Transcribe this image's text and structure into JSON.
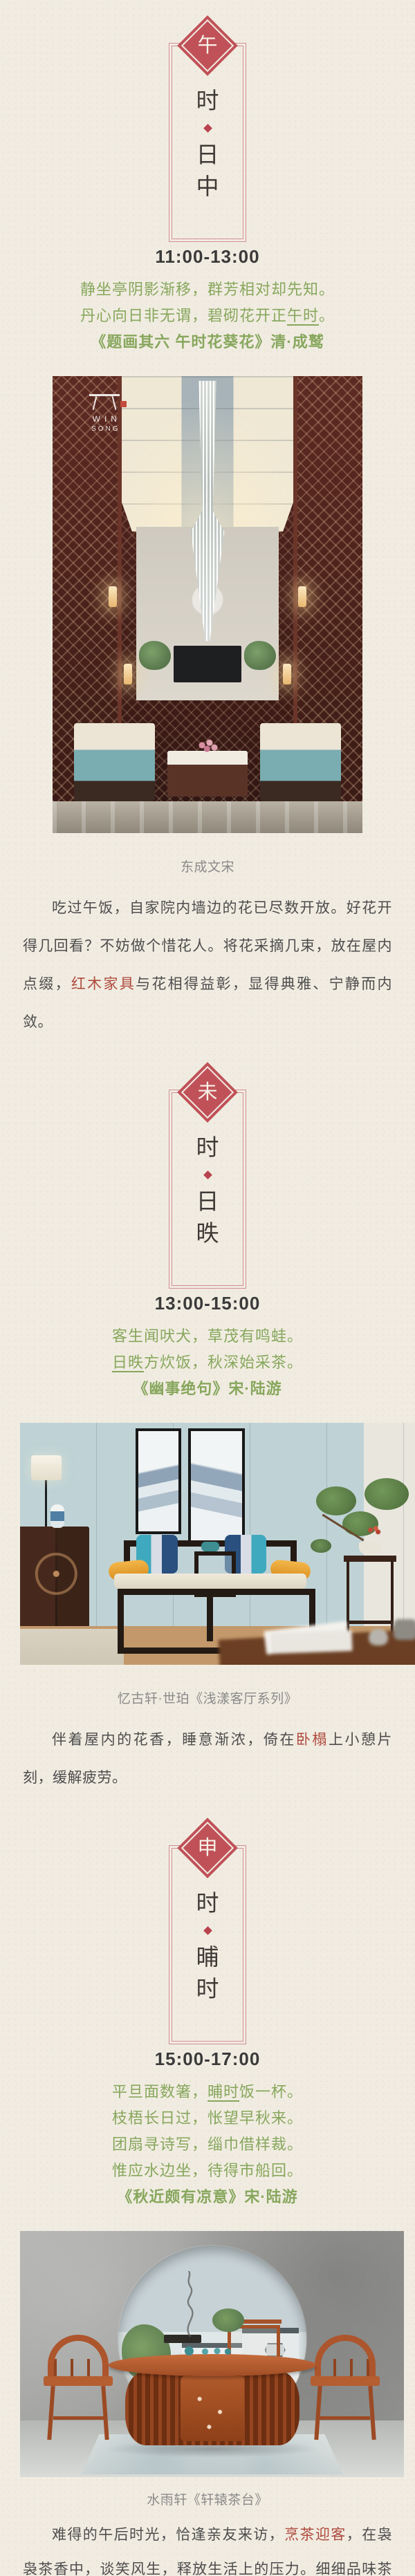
{
  "colors": {
    "background": "#f1ece1",
    "accent_red": "#c05158",
    "frame_rose": "#d28e96",
    "bullet_red": "#b8434e",
    "poem_green": "#87a75d",
    "link_red": "#ae4a3e",
    "body_text": "#4d4d4d",
    "caption_gray": "#8a8a8a",
    "time_text": "#3a3a3a"
  },
  "sections": [
    {
      "branch": "午",
      "frame_chars": [
        "时",
        "日",
        "中"
      ],
      "time_label": "11:00-13:00",
      "poem": {
        "lines": [
          {
            "pre": "静坐亭阴影渐移，群芳相对却先知。",
            "u": "",
            "post": ""
          },
          {
            "pre": "丹心向日非无谓，碧砌花开正",
            "u": "午时",
            "post": "。"
          }
        ],
        "source": "《题画其六 午时花葵花》清·成鹫"
      },
      "photo": {
        "watermark_top": "WIN",
        "watermark_bottom": "SONG"
      },
      "caption": "东成文宋",
      "paragraph": {
        "pre": "吃过午饭，自家院内墙边的花已尽数开放。好花开得几回看？不妨做个惜花人。将花采摘几束，放在屋内点缀，",
        "hl": "红木家具",
        "post": "与花相得益彰，显得典雅、宁静而内敛。"
      }
    },
    {
      "branch": "未",
      "frame_chars": [
        "时",
        "日",
        "昳"
      ],
      "time_label": "13:00-15:00",
      "poem": {
        "lines": [
          {
            "pre": "客生闻吠犬，草茂有鸣蛙。",
            "u": "",
            "post": ""
          },
          {
            "pre": "",
            "u": "日昳",
            "post": "方炊饭，秋深始采茶。"
          }
        ],
        "source": "《幽事绝句》宋·陆游"
      },
      "caption": "忆古轩·世珀《浅漾客厅系列》",
      "paragraph": {
        "pre": "伴着屋内的花香，睡意渐浓，倚在",
        "hl": "卧榻",
        "post": "上小憩片刻，缓解疲劳。"
      }
    },
    {
      "branch": "申",
      "frame_chars": [
        "时",
        "晡",
        "时"
      ],
      "time_label": "15:00-17:00",
      "poem": {
        "lines": [
          {
            "pre": "平旦面数箸，",
            "u": "晡时",
            "post": "饭一杯。"
          },
          {
            "pre": "枝梧长日过，怅望早秋来。",
            "u": "",
            "post": ""
          },
          {
            "pre": "团扇寻诗写，缁巾借样裁。",
            "u": "",
            "post": ""
          },
          {
            "pre": "惟应水边坐，待得市船回。",
            "u": "",
            "post": ""
          }
        ],
        "source": "《秋近颇有凉意》宋·陆游"
      },
      "caption": "水雨轩《轩辕茶台》",
      "paragraph": {
        "pre": "难得的午后时光，恰逢亲友来访，",
        "hl": "烹茶迎客",
        "post": "，在袅袅茶香中，谈笑风生，释放生活上的压力。细细品味茶香，感受悠闲恬静的诗意生活。"
      }
    }
  ]
}
